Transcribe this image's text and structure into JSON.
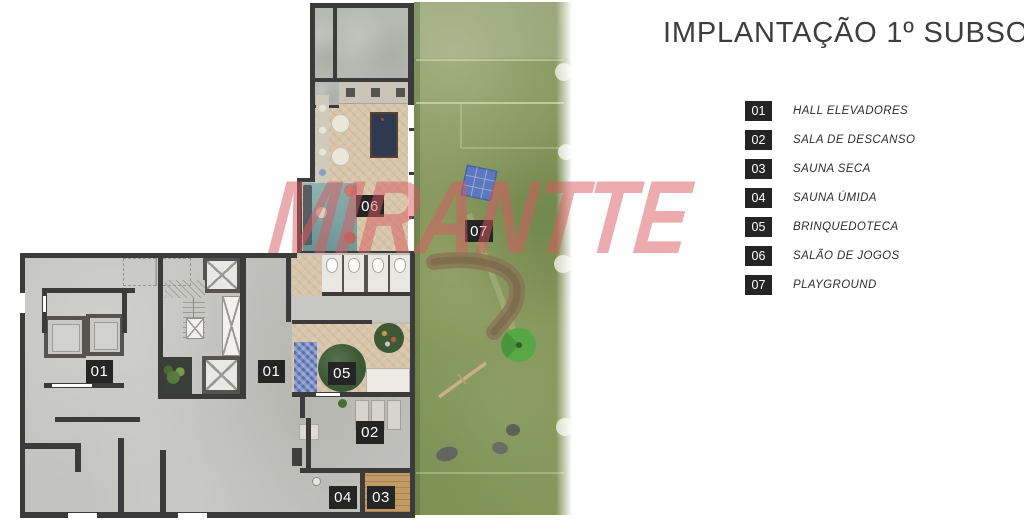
{
  "title": "IMPLANTAÇÃO 1º SUBSOLO",
  "watermark": "MIRANTTE",
  "legend": {
    "items": [
      {
        "num": "01",
        "label": "HALL ELEVADORES"
      },
      {
        "num": "02",
        "label": "SALA DE DESCANSO"
      },
      {
        "num": "03",
        "label": "SAUNA SECA"
      },
      {
        "num": "04",
        "label": "SAUNA ÚMIDA"
      },
      {
        "num": "05",
        "label": "BRINQUEDOTECA"
      },
      {
        "num": "06",
        "label": "SALÃO DE JOGOS"
      },
      {
        "num": "07",
        "label": "PLAYGROUND"
      }
    ]
  },
  "markers": {
    "hall": "01",
    "descanso": "02",
    "sauna_seca": "03",
    "sauna_umida": "04",
    "brinquedoteca": "05",
    "jogos": "06",
    "playground": "07"
  },
  "colors": {
    "wall": "#3b3b3b",
    "concrete": "#c3c3bf",
    "wood": "#d8c5aa",
    "garden": "#85955a",
    "watermark": "#d95a61",
    "marker-bg": "#252525",
    "marker-text": "#ffffff",
    "legend-box": "#242424",
    "title-text": "#3d3d3d",
    "teal-rug": "#7ba4a2",
    "pool-table": "#2d3a51",
    "ballpit": "#7388c4",
    "play-rug": "#3d5834",
    "sauna-wood": "#c29a63"
  }
}
